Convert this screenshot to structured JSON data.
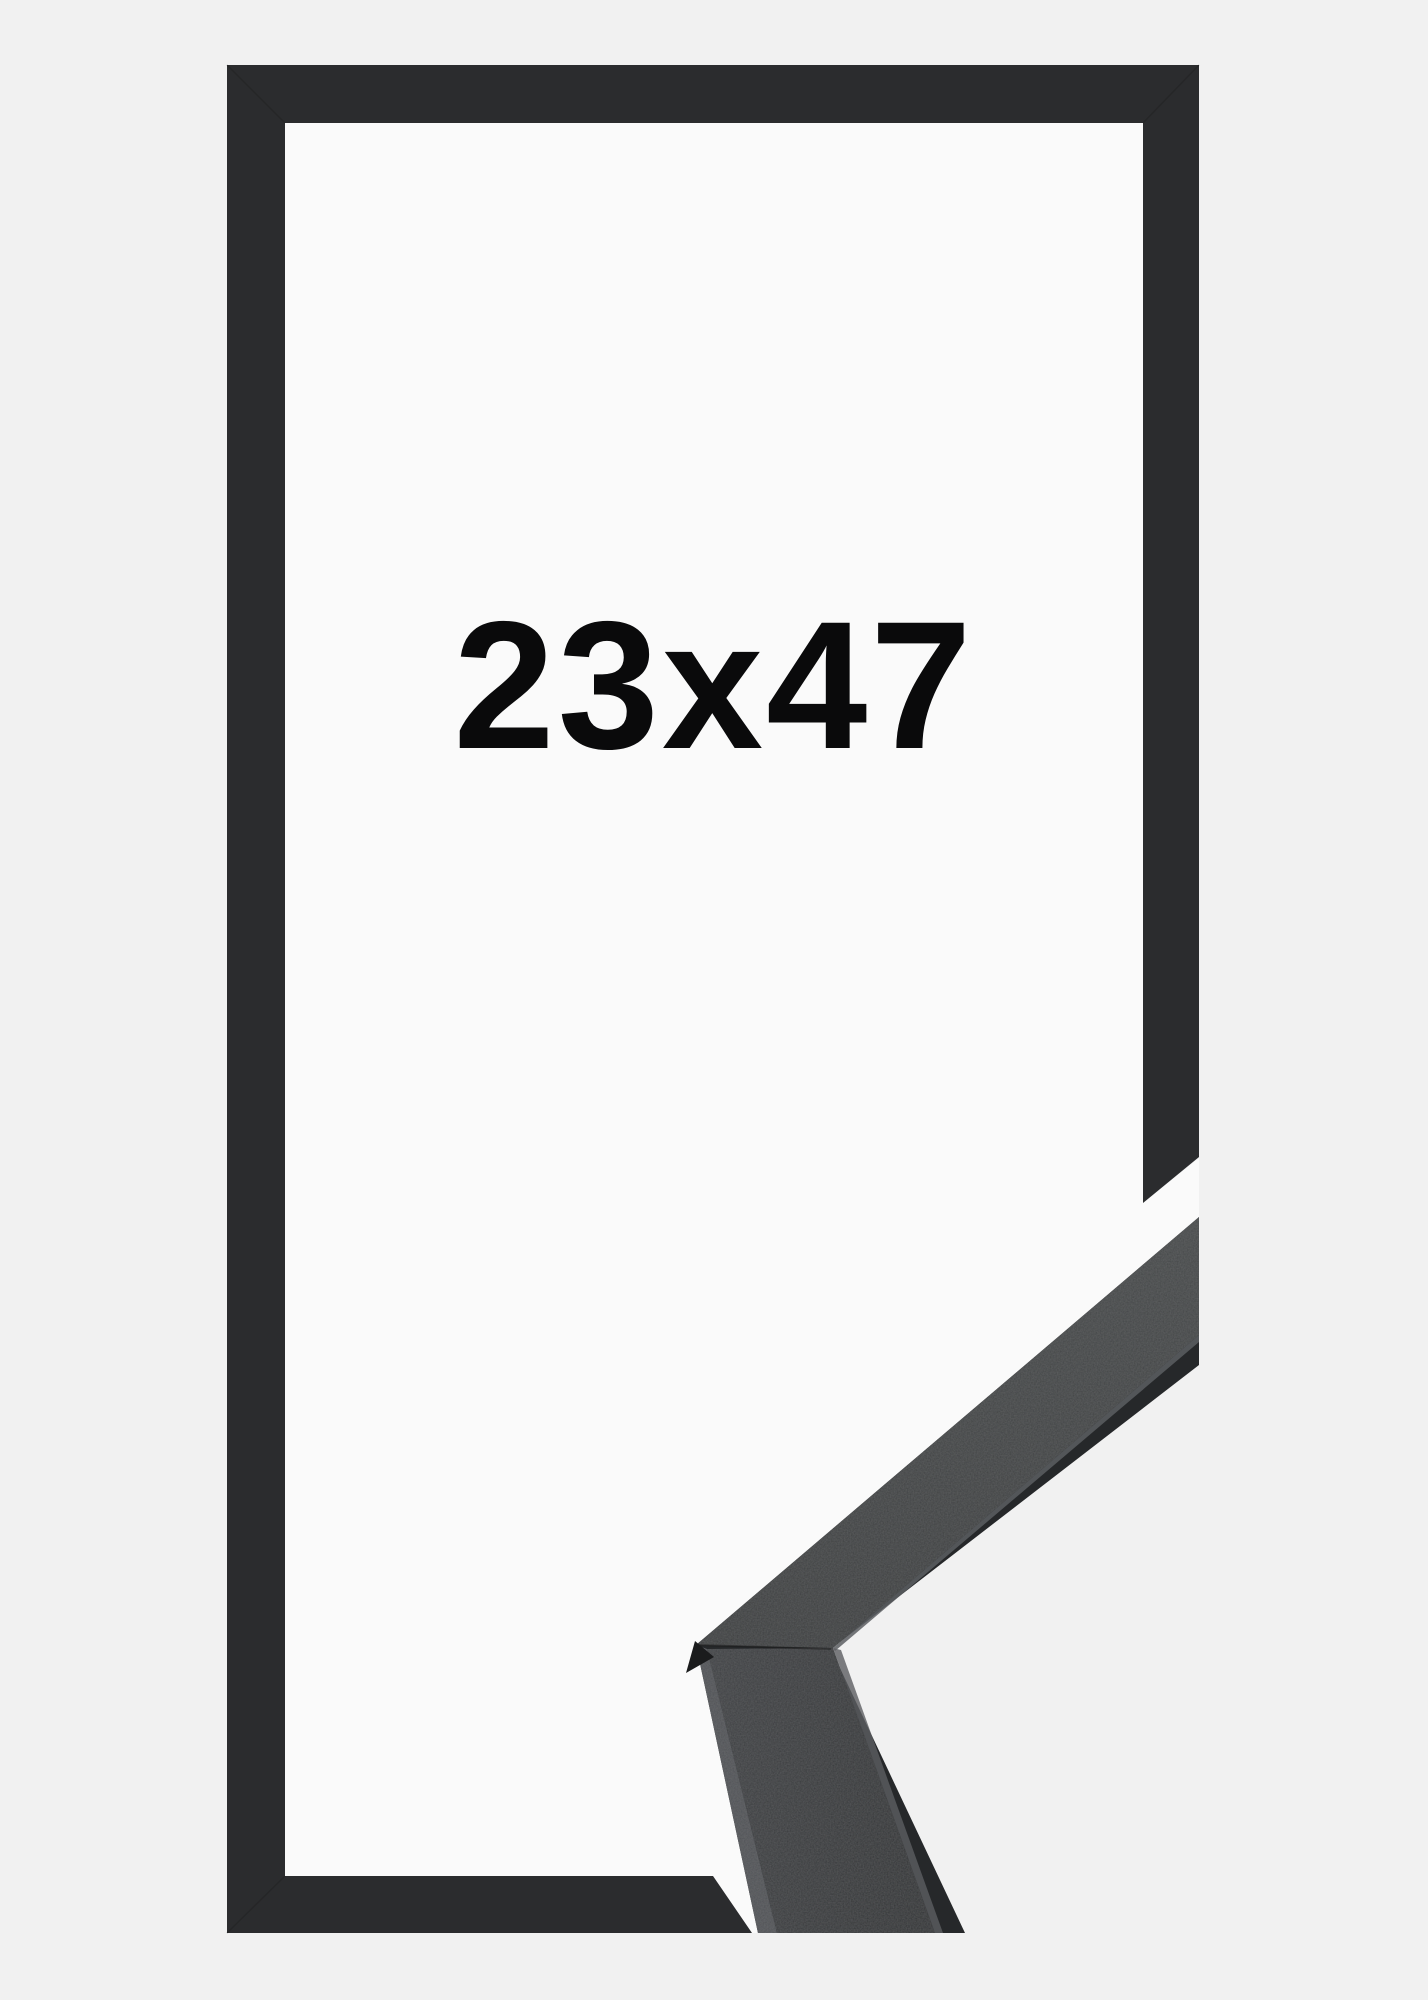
{
  "product": {
    "size_label": "23x47",
    "colors": {
      "background": "#F1F1F1",
      "canvas": "#FAFAFA",
      "frame": "#2B2C2E",
      "label_text": "#0A0A0B",
      "molding_face_upper": "#404243",
      "molding_face_lower": "#353739",
      "molding_facet_light": "#4F5155",
      "molding_edge_dark": "#26282A",
      "molding_hairline": "#5C5E61",
      "molding_corner_tip": "#1B1C1D",
      "miter_seam": "#1A1A1A"
    }
  }
}
